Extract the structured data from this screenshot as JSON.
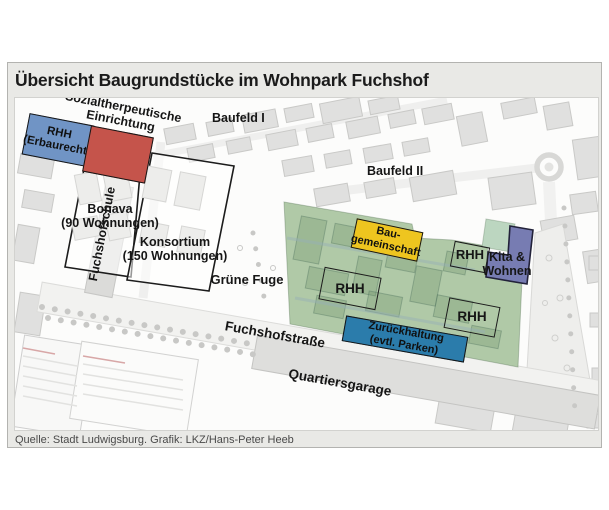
{
  "title": "Übersicht Baugrundstücke im Wohnpark Fuchshof",
  "source": "Quelle: Stadt Ludwigsburg. Grafik: LKZ/Hans-Peter Heeb",
  "plots": {
    "rhh_erbaurecht": {
      "label_line1": "RHH",
      "label_line2": "(Erbaurecht)",
      "color": "#7094c5"
    },
    "sozial_einrichtung": {
      "label_line1": "Sozialtherpeutische",
      "label_line2": "Einrichtung",
      "color": "#c5544b"
    },
    "baugemeinschaft": {
      "label_line1": "Bau-",
      "label_line2": "gemeinschaft",
      "color": "#eec51f"
    },
    "kita_wohnen": {
      "label_line1": "Kita &",
      "label_line2": "Wohnen",
      "color": "#777cb2"
    },
    "zurueckhaltung": {
      "label_line1": "Zurückhaltung",
      "label_line2": "(evtl. Parken)",
      "color": "#2b7cab"
    },
    "bonava": {
      "label_line1": "Bonava",
      "label_line2": "(90 Wohnungen)"
    },
    "konsortium": {
      "label_line1": "Konsortium",
      "label_line2": "(150 Wohnungen)"
    },
    "wohnpark": {
      "color": "#b0c9a7",
      "rhh_label_1": "RHH",
      "rhh_label_2": "RHH",
      "rhh_strip_label": "RHH"
    },
    "kita_green": {
      "color": "#bcd6c0"
    }
  },
  "map_labels": {
    "baufeld_1": "Baufeld I",
    "baufeld_2": "Baufeld II",
    "fuchshofschule": "Fuchshofschule",
    "gruene_fuge": "Grüne Fuge",
    "fuchshofstrasse": "Fuchshofstraße",
    "quartiersgarage": "Quartiersgarage"
  }
}
